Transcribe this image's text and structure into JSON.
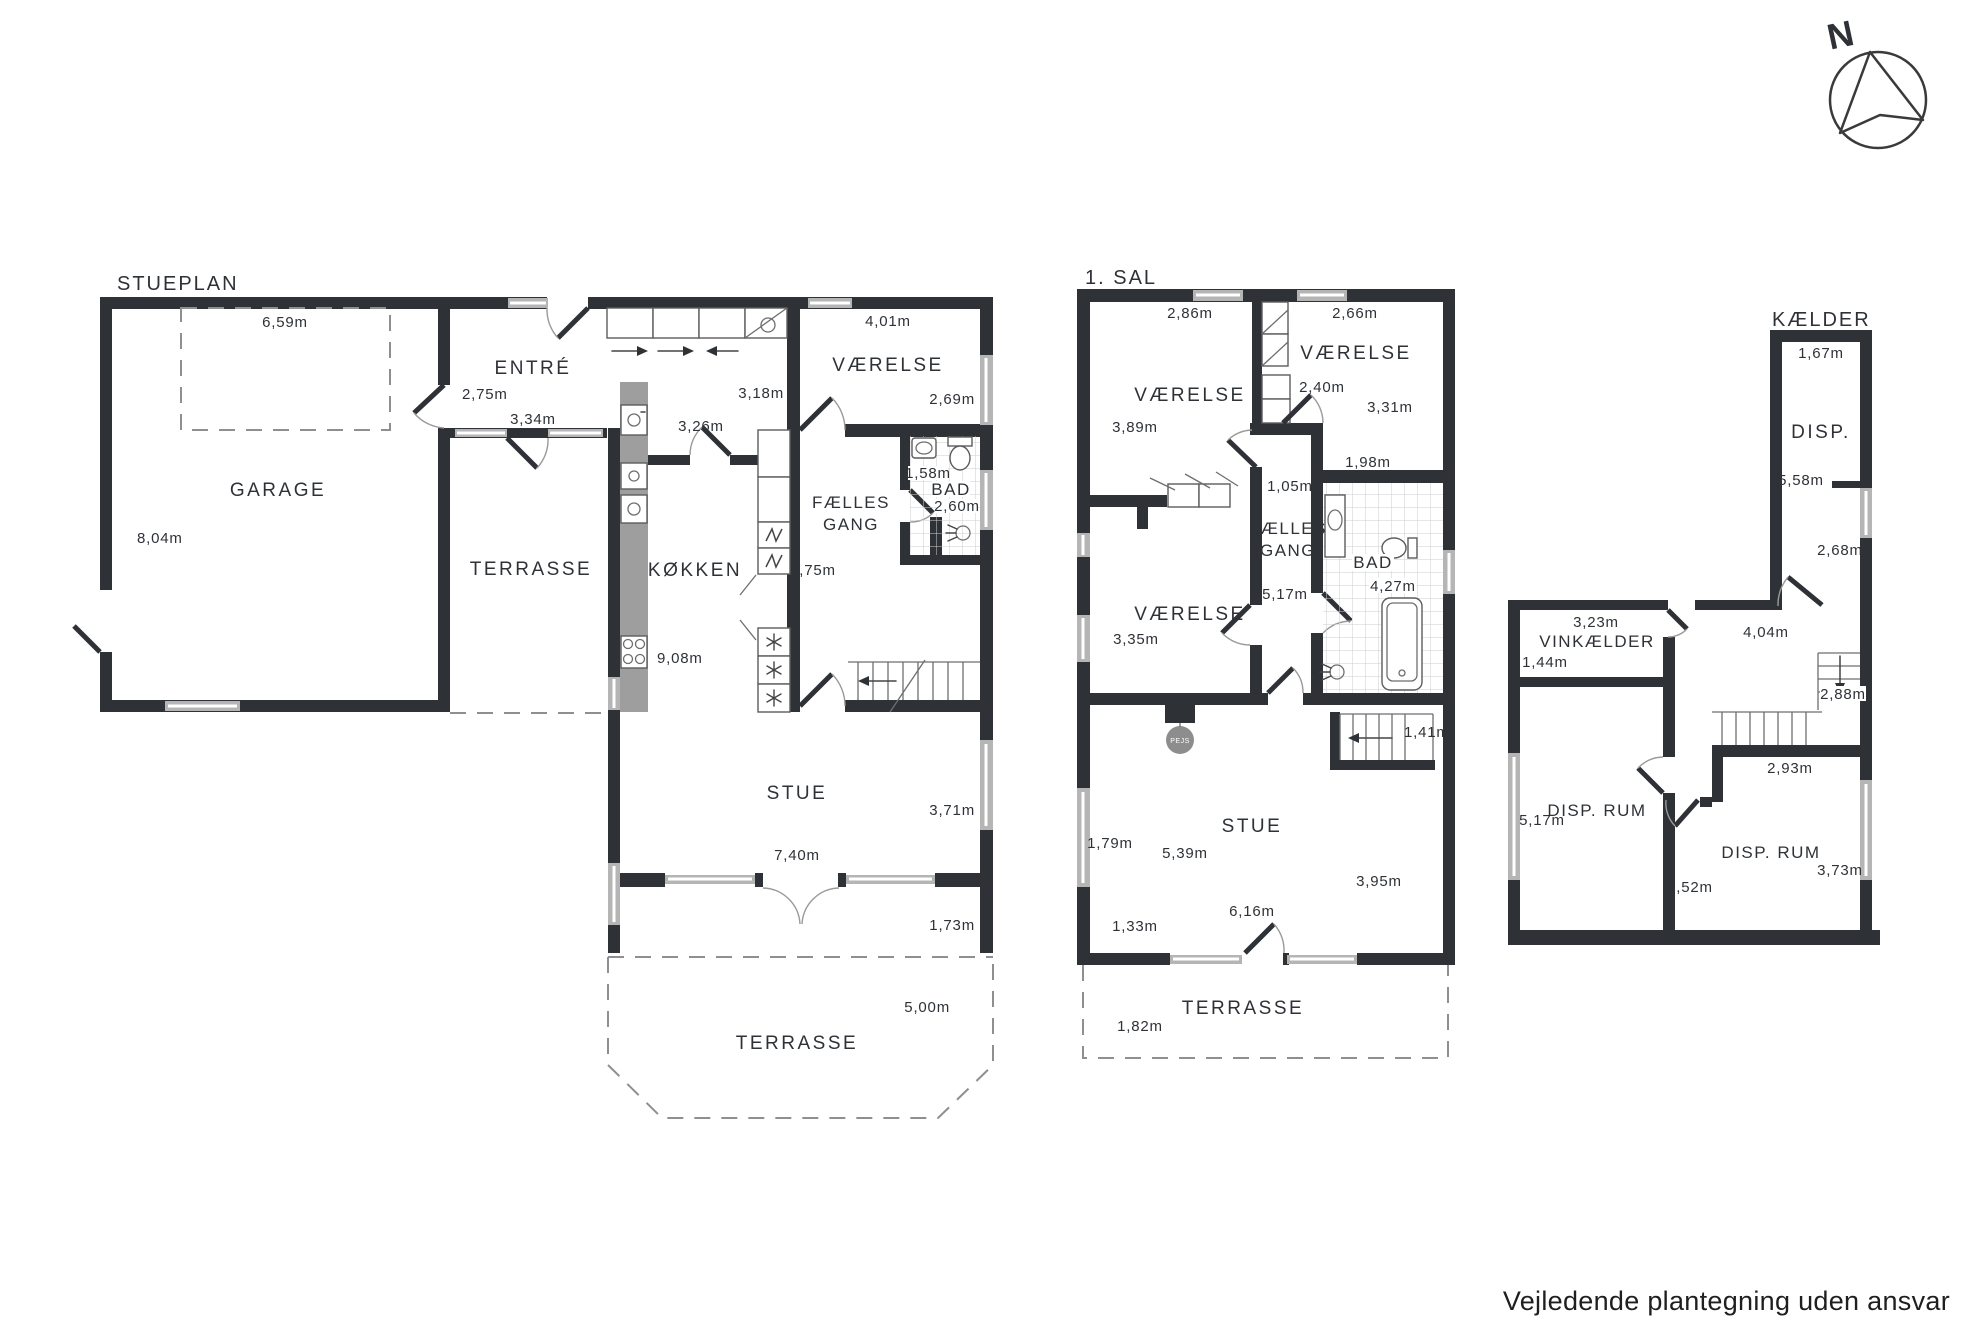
{
  "footer": "Vejledende plantegning uden ansvar",
  "compass": {
    "north": "N"
  },
  "colors": {
    "wall": "#2e3237",
    "window_gray": "#b5b5b5",
    "counter_gray": "#9e9e9e",
    "fireplace_gray": "#8d8d8d"
  },
  "stueplan": {
    "title": "STUEPLAN",
    "garage": {
      "name": "GARAGE",
      "width": "6,59m",
      "depth": "8,04m"
    },
    "entre": {
      "name": "ENTRÉ",
      "door": "2,75m",
      "width": "3,34m",
      "depth": "3,18m"
    },
    "terrasse_vest": {
      "name": "TERRASSE"
    },
    "kokken": {
      "name": "KØKKEN",
      "width": "3,26m",
      "length": "9,08m"
    },
    "gang": {
      "line1": "FÆLLES",
      "line2": "GANG",
      "length": "5,75m"
    },
    "vaerelse": {
      "name": "VÆRELSE",
      "width": "4,01m",
      "depth": "2,69m"
    },
    "bad": {
      "name": "BAD",
      "width": "1,58m",
      "depth": "2,60m"
    },
    "stue": {
      "name": "STUE",
      "depth": "3,71m",
      "width": "7,40m",
      "porch": "1,73m"
    },
    "terrasse_syd": {
      "name": "TERRASSE",
      "depth": "5,00m"
    }
  },
  "sal": {
    "title": "1. SAL",
    "vaerelse_nv": {
      "name": "VÆRELSE",
      "width": "2,86m",
      "depth": "3,89m"
    },
    "vaerelse_no": {
      "name": "VÆRELSE",
      "width": "2,66m",
      "closet": "2,40m",
      "depth": "3,31m"
    },
    "vaerelse_sv": {
      "name": "VÆRELSE",
      "width": "3,35m"
    },
    "gang": {
      "line1": "FÆLLES",
      "line2": "GANG",
      "width": "1,05m",
      "length": "5,17m"
    },
    "bad": {
      "name": "BAD",
      "top": "1,98m",
      "length": "4,27m"
    },
    "pejs": {
      "name": "PEJS"
    },
    "stair": {
      "width": "1,41m"
    },
    "stue": {
      "name": "STUE",
      "width": "5,39m",
      "depth": "3,95m",
      "window": "1,79m",
      "door": "6,16m",
      "side": "1,33m"
    },
    "terrasse": {
      "name": "TERRASSE",
      "depth": "1,82m"
    }
  },
  "kaelder": {
    "title": "KÆLDER",
    "disp": {
      "name": "DISP.",
      "width": "1,67m",
      "length": "5,58m",
      "door": "2,68m"
    },
    "vinkaelder": {
      "name": "VINKÆLDER",
      "width": "3,23m",
      "depth": "1,44m"
    },
    "hall": {
      "width": "4,04m",
      "stair": "2,88m"
    },
    "disp_rum_vest": {
      "name": "DISP. RUM",
      "length": "5,17m"
    },
    "disp_rum_ost": {
      "name": "DISP. RUM",
      "top": "2,93m",
      "door": "2,52m",
      "depth": "3,73m"
    }
  }
}
